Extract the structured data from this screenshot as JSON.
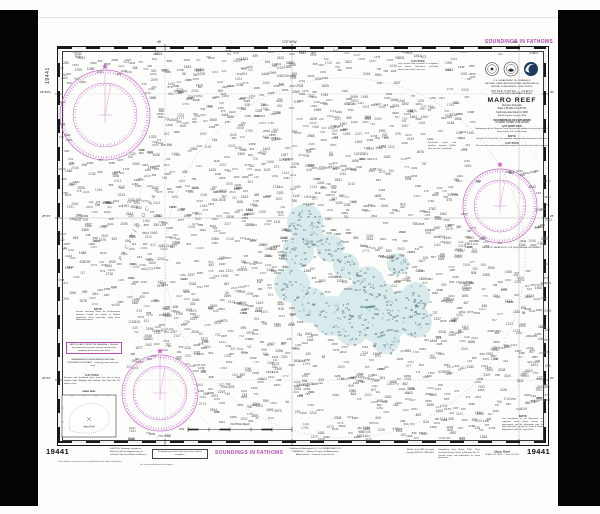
{
  "page": {
    "chart_number": "19441",
    "top_right_label": "SOUNDINGS IN FATHOMS",
    "bottom_center_label": "SOUNDINGS IN FATHOMS",
    "left_vertical_number": "19441",
    "bottom_left_number": "19441",
    "bottom_right_number": "19441",
    "ocean_label": "PACIFIC OCEAN",
    "reef_label": "Maro Reef"
  },
  "colors": {
    "magenta": "#b44ab4",
    "green": "#2f9e55",
    "reef_fill": "#d9eaec",
    "reef_patch": "#bcdbe0",
    "ink": "#1d1d1d",
    "grid": "#b5b5b5",
    "sounding": "#474747"
  },
  "title_block": {
    "dept1": "U.S. DEPARTMENT OF COMMERCE",
    "dept2": "NATIONAL OCEANIC AND ATMOSPHERIC ADMINISTRATION",
    "dept3": "NATIONAL OCEAN SERVICE  •  COAST SURVEY",
    "region": "UNITED STATES — HAWAII",
    "subregion": "NORTHWESTERN HAWAIIAN ISLANDS",
    "title": "MARO REEF",
    "projection": "Mercator Projection",
    "scale": "Scale 1:85,000 at Lat 25°25'",
    "datum": "North American Datum of 1983",
    "datum2": "(World Geodetic System 1984)",
    "units": "SOUNDINGS IN FATHOMS",
    "units2": "AT MEAN LOWER LOW WATER",
    "auth_header": "AUTHORITIES",
    "auth_text": "Hydrography by the National Ocean Service with additional surveys by the U.S. Navy and the U.S. Coast Guard.",
    "note_header": "NOTE",
    "note_text": "Consult U.S. Coast Pilot 7 for important supplemental information for this area.",
    "caution_header": "CAUTION",
    "caution_text": "This area has not been completely surveyed. Uncharted coral heads may exist.",
    "variation_note": "MAGNETIC VARIATION 11°15'E (2005)  ANNUAL DECREASE 2'"
  },
  "graticule": {
    "top_ticks": [
      "45'",
      "170°40'W",
      "35'"
    ],
    "left_ticks": [
      "25°30'N",
      "25°25'",
      "25°20'"
    ],
    "right_ticks": [
      "30'",
      "25'",
      "20'"
    ]
  },
  "notes_left": {
    "note_header": "NOTE",
    "note_text": "Vessels operating within the Northwestern Hawaiian Islands are subject to Federal regulations. Entry restrictions apply within Monument waters.",
    "magenta_box_text": "PARTICULARLY SENSITIVE SEA AREA — Mariners are requested to exercise extreme caution when navigating these waters (see note).",
    "green_text": "PAPAHANAUMOKUAKEA MARINE NATIONAL MONUMENT BOUNDARY — Entry by permit only (see note).",
    "caution_header": "CAUTION",
    "caution_text": "Breakers and discolored water mark the reef in heavy weather only. Navigate with extreme care near the 10-fathom curve.",
    "inset_header": "MARO REEF",
    "inset_label": "Maro Reef",
    "inset_caption": "(Location Diagram)"
  },
  "notes_top": {
    "caution_header": "CAUTION",
    "caution_text": "Only charted aids essential to navigation are shown. Numerous uncharted obstructions exist in this area."
  },
  "notes_mid_right": {
    "text": "Discolored water and breakers reported (2004). Give the reef a wide berth."
  },
  "notes_right_bottom": {
    "note_header": "NOTE",
    "note_text": "The boundaries of the Monument and regulated areas shown hereon are approximate and for information only. For legal definitions consult the Code of Federal Regulations and U.S. Coast Pilot 7."
  },
  "bottom_margin": {
    "magenta_note": "CAUTION: Temporary changes or defects in aids to navigation are not indicated. See Local Notice to Mariners.",
    "boxed_note": "A reproduction of this chart may not be used for navigation.",
    "publication_note": "Published at Washington, D.C. U.S. DEPARTMENT OF COMMERCE — National Oceanic and Atmospheric Administration — National Ocean Service",
    "edition_note": "4th Ed., June 2005 Corrected through NM 21/05 LNM 18/05",
    "corrections_note": "Compilation date March 2005. Chart corrected through Notice to Mariners No. 21. Consult charts and publications for latest information.",
    "right_title": "Maro Reef",
    "right_subtitle": "NOAA Chart 19441 — Scale 1:85,000",
    "fineprint1": "Chart editions and corrections are published in the Notice to Mariners.",
    "fineprint2": "For sale by authorized sales agents."
  },
  "scale_bar": {
    "label": "NAUTICAL MILES",
    "left_value": "1",
    "right_value": "4"
  },
  "soundings": {
    "seed": 20441,
    "ocean_count": 1850,
    "reef_count": 330,
    "rock_count": 55,
    "patch_count": 26,
    "ocean_value_range": [
      80,
      2700
    ],
    "reef_value_range": [
      1,
      45
    ]
  }
}
